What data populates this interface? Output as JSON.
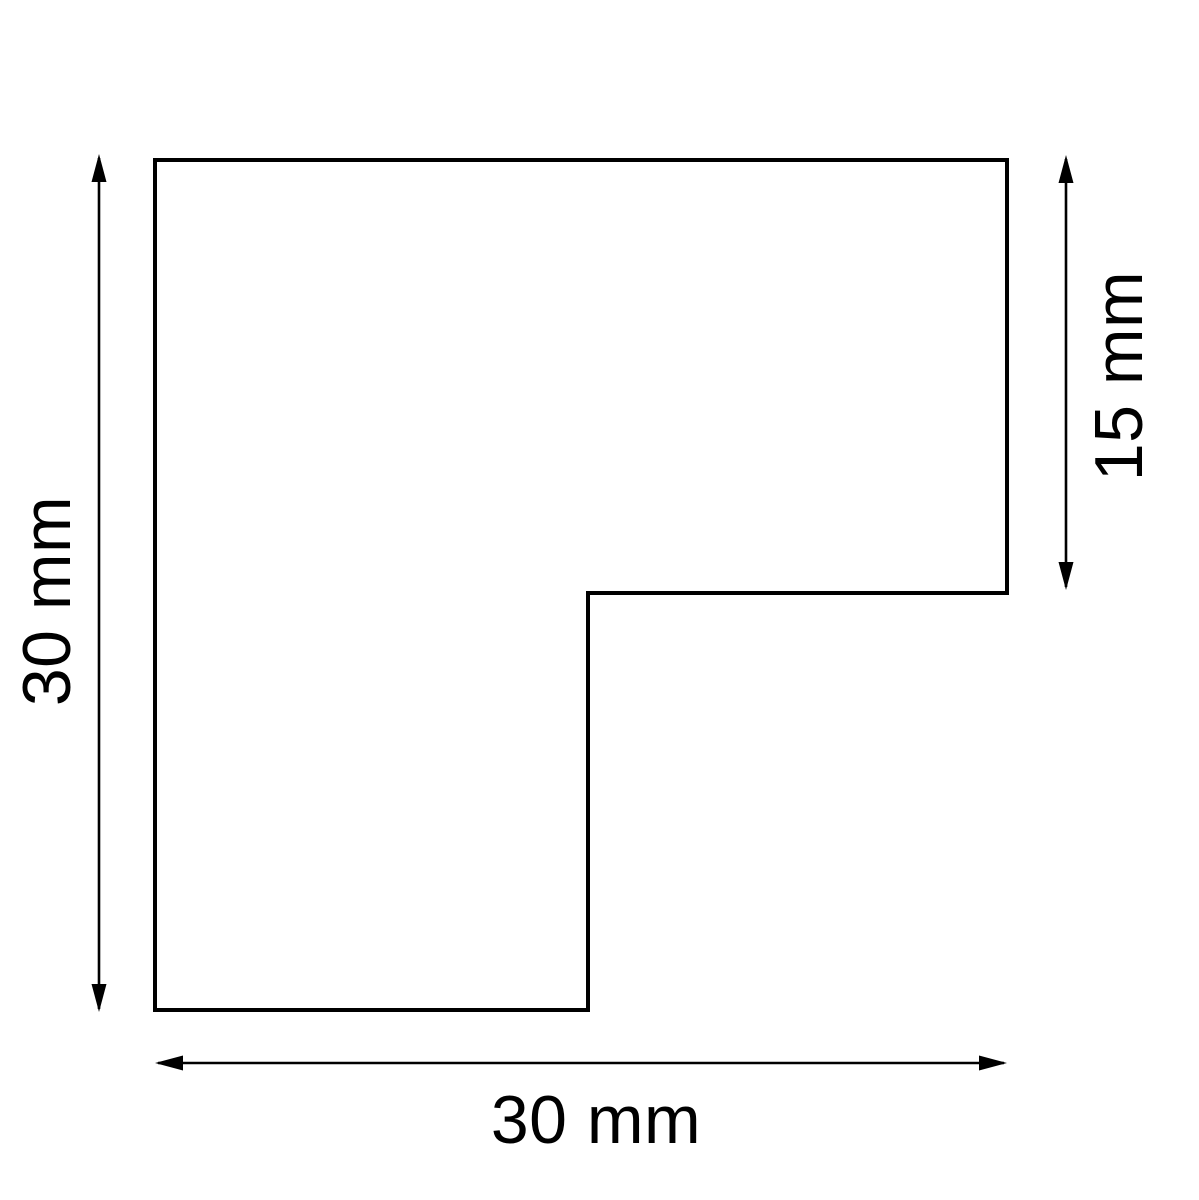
{
  "drawing": {
    "kind": "technical-dimension-drawing",
    "part": {
      "name": "L-shaped corner profile",
      "outline_points": "155,160 1007,160 1007,593 588,593 588,1010 155,1010",
      "outline_color": "#000000",
      "fill_color": "#ffffff"
    },
    "dimensions": {
      "left_height": {
        "label": "30 mm",
        "value": 30,
        "unit": "mm",
        "orientation": "vertical",
        "side": "left"
      },
      "right_height": {
        "label": "15 mm",
        "value": 15,
        "unit": "mm",
        "orientation": "vertical",
        "side": "right"
      },
      "bottom_width": {
        "label": "30 mm",
        "value": 30,
        "unit": "mm",
        "orientation": "horizontal",
        "side": "bottom"
      }
    },
    "colors": {
      "line": "#000000",
      "text": "#000000",
      "background": "#ffffff"
    }
  }
}
